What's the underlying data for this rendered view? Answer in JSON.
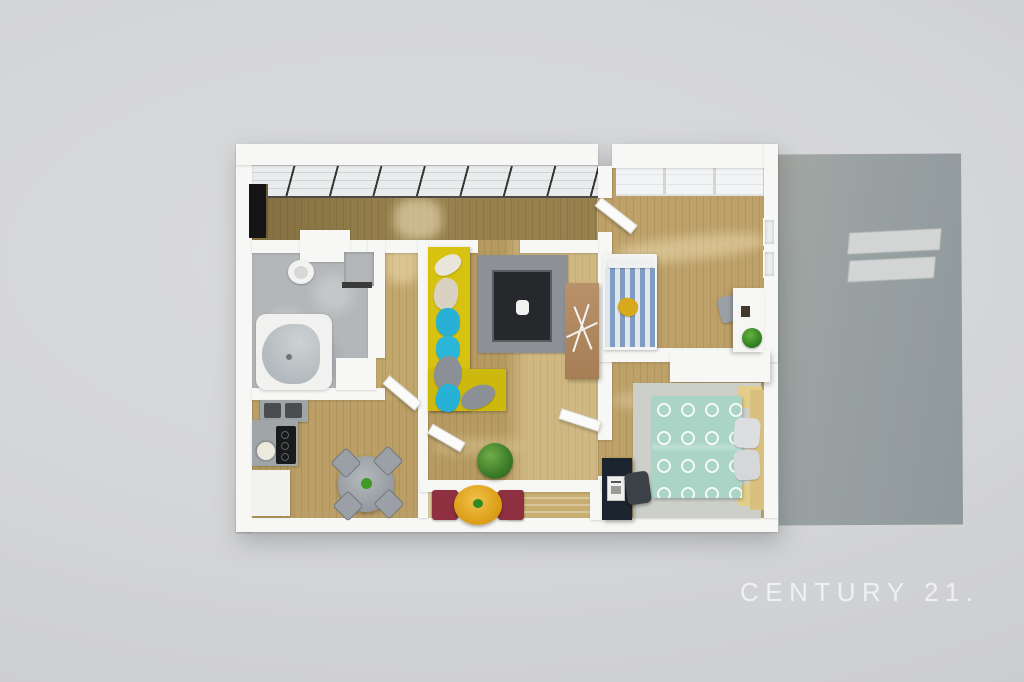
{
  "watermark": {
    "text": "CENTURY 21."
  },
  "scene": {
    "type": "3d-apartment-floor-plan-top-down-render",
    "background_color": "#d4d5d7",
    "wall_color": "#f7f7f5",
    "cast_shadow": {
      "color": "#99a1a2",
      "light_bar_color": "#d2d5d4",
      "light_bar_count": 2
    },
    "floorplan": {
      "rooms": [
        {
          "id": "balcony",
          "name": "glazed balcony strip",
          "floor_color": "#97814e",
          "items": [
            "window-row-dark-mullions",
            "tv-panel"
          ]
        },
        {
          "id": "living-room",
          "name": "living room",
          "floor_color": "#c3a76b",
          "items": [
            "yellow-corner-sofa",
            "throw-pillows",
            "gray-rug",
            "black-coffee-table",
            "game-controller",
            "wood-sideboard",
            "white-branch-decor"
          ],
          "sofa_color": "#d6c20f",
          "pillow_colors": [
            "#e9e5da",
            "#d9d2c2",
            "#27b1d6",
            "#8b9097"
          ],
          "rug_color": "#8d9196",
          "coffee_table_color": "#26282c",
          "sideboard_color": "#b08a60"
        },
        {
          "id": "bathroom",
          "name": "bathroom",
          "floor_color": "#b4b7b9",
          "items": [
            "corner-bathtub",
            "toilet",
            "vanity-counter",
            "washer",
            "cabinet",
            "open-door"
          ]
        },
        {
          "id": "kitchen-dining",
          "name": "kitchen and dining room",
          "floor_color": "#bb9f66",
          "items": [
            "double-sink-counter",
            "round-sink",
            "black-cooktop",
            "fridge-cabinet",
            "round-dining-table",
            "dining-chairs"
          ],
          "counter_color": "#a0a5a8",
          "cooktop_color": "#191a1c",
          "table_color": "#a3a8ac",
          "chair_count": 4
        },
        {
          "id": "bedroom-1",
          "name": "top bedroom",
          "floor_color": "#bda169",
          "items": [
            "striped-single-bed",
            "yellow-cushion",
            "white-desk",
            "desk-chair",
            "potted-plant",
            "wall-niches",
            "open-door",
            "window-row"
          ],
          "bed_stripe_colors": [
            "#7f9dc2",
            "#e0e6eb"
          ]
        },
        {
          "id": "bedroom-2",
          "name": "bottom bedroom",
          "floor_color": "#bda169",
          "items": [
            "teal-pattern-double-bed",
            "gray-pillows",
            "wood-headboard",
            "navy-desk",
            "laptop",
            "desk-chair",
            "light-rug",
            "wardrobe-closet"
          ],
          "duvet_color": "#a9d4c6",
          "headboard_color": "#d9c07e",
          "desk_color": "#1c2430",
          "rug_color": "#cccfc9"
        },
        {
          "id": "hallway-entry",
          "name": "hallway and entry nook",
          "floor_color": "#c2a76c",
          "items": [
            "potted-plant",
            "open-doors",
            "yellow-entry-table",
            "maroon-chairs"
          ],
          "entry_table_color": "#e0a418",
          "entry_chair_color": "#8e3040"
        }
      ]
    }
  }
}
